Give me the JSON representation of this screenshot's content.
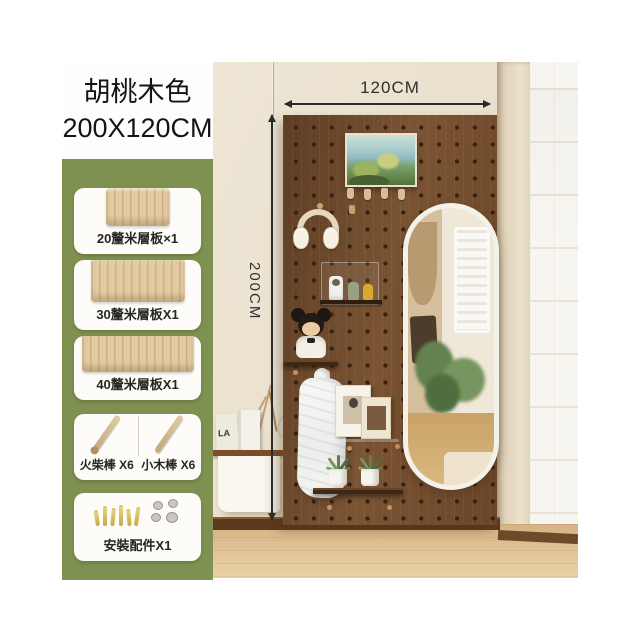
{
  "product": {
    "color_name": "胡桃木色",
    "size": "200X120CM"
  },
  "dimensions": {
    "width": "120CM",
    "height": "200CM"
  },
  "components": [
    {
      "label": "20釐米層板×1"
    },
    {
      "label": "30釐米層板X1"
    },
    {
      "label": "40釐米層板X1"
    },
    {
      "left_label": "火柴棒 X6",
      "right_label": "小木棒 X6"
    },
    {
      "label": "安裝配件X1"
    }
  ],
  "scene": {
    "bag_text": "LA"
  },
  "colors": {
    "panel_green": "#7e9150",
    "pegboard_brown": "#6f4a2b",
    "wall_beige": "#ebe2d1",
    "floor_wood": "#dcbe92",
    "arrow_black": "#2b2b2b"
  }
}
